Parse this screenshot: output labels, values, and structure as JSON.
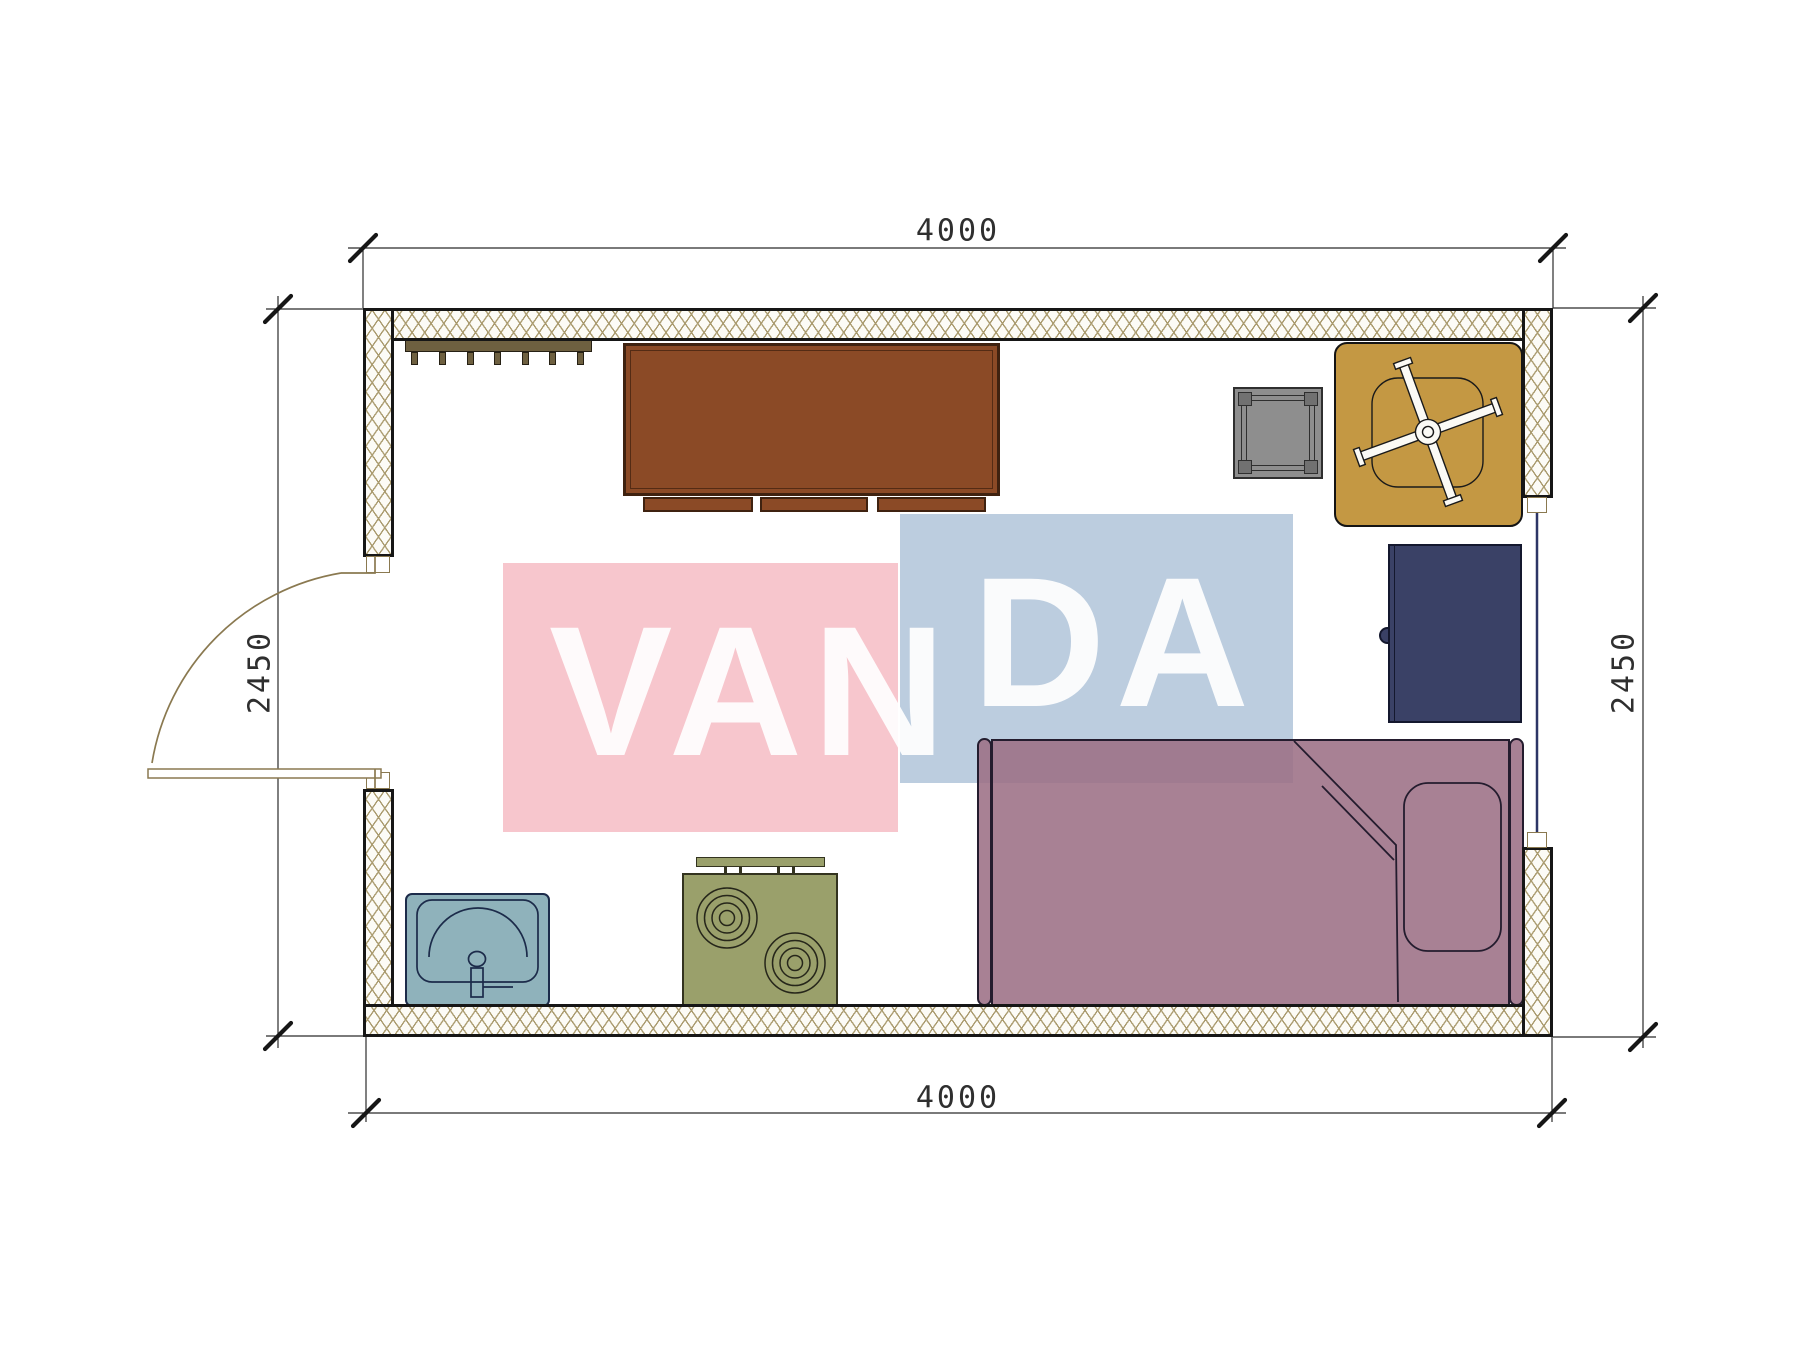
{
  "dimensions": {
    "top": "4000",
    "bottom": "4000",
    "left": "2450",
    "right": "2450"
  },
  "watermark": {
    "text_left": "VAN",
    "text_right": "DA"
  },
  "colors": {
    "pink": "#f7c6cd",
    "blue": "#bccddf",
    "watermark_text": "#ffffff",
    "wall_border": "#161616",
    "hatch_line": "#ab9c70",
    "hatch_bg": "#fcfbf6",
    "dim_line": "#2b2b2b",
    "dim_text": "#2f2f2f",
    "door": "#8a7950",
    "rack": "#6e6040",
    "rack_dark": "#262014",
    "desk": "#8b4a26",
    "desk_border": "#3f2210",
    "stool": "#8e8e8e",
    "stool_leg": "#717171",
    "stool_line": "#2f2f2f",
    "table": "#c49843",
    "table_line": "#141414",
    "chair_fill": "#fbfaf5",
    "chair_line": "#1a1a1a",
    "cabinet": "#3a4166",
    "cabinet_border": "#14182e",
    "bed": "rgba(156,112,133,0.88)",
    "bed_line": "#241c2e",
    "sink": "#8fb2bb",
    "sink_line": "#1c2b4a",
    "stove": "#9aa06b",
    "stove_line": "#33331f",
    "burner_line": "#26261a",
    "window_line": "#2c3566"
  }
}
